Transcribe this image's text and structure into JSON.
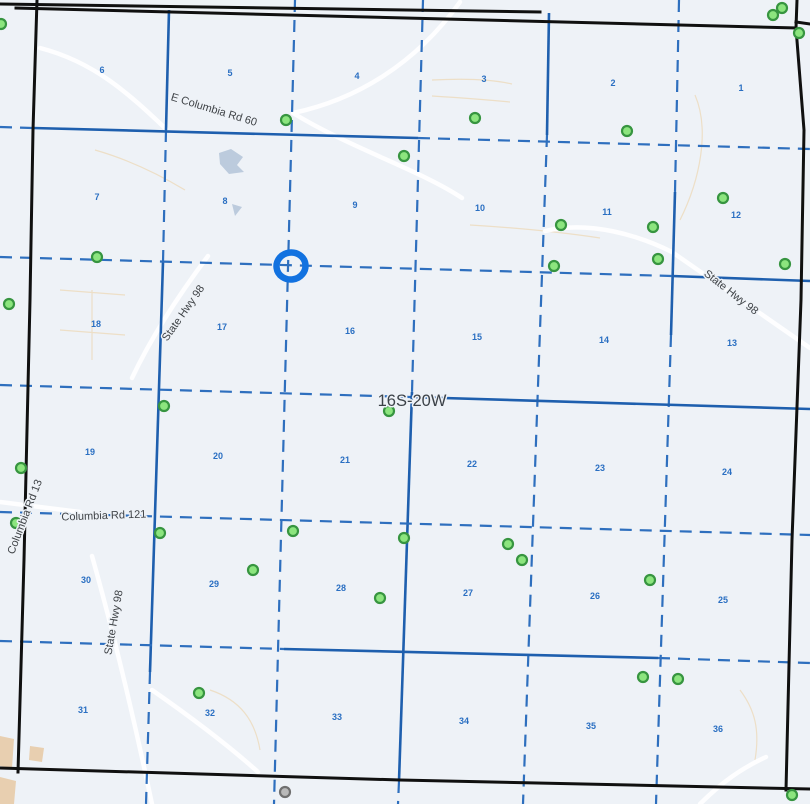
{
  "map": {
    "width": 810,
    "height": 804,
    "background": "#eef2f7"
  },
  "township_label": {
    "text": "16S-20W",
    "x": 412,
    "y": 406
  },
  "road_labels": [
    {
      "label": "E Columbia Rd 60",
      "x": 213,
      "y": 113,
      "rotation": 17
    },
    {
      "label": "State Hwy 98",
      "x": 186,
      "y": 315,
      "rotation": -55
    },
    {
      "label": "State Hwy 98",
      "x": 729,
      "y": 295,
      "rotation": 38
    },
    {
      "label": "Columbia Rd 13",
      "x": 28,
      "y": 518,
      "rotation": -69
    },
    {
      "label": "Columbia Rd 121",
      "x": 104,
      "y": 519,
      "rotation": -2
    },
    {
      "label": "State Hwy 98",
      "x": 117,
      "y": 623,
      "rotation": -80
    }
  ],
  "section_numbers": [
    {
      "n": "6",
      "x": 102,
      "y": 73
    },
    {
      "n": "5",
      "x": 230,
      "y": 76
    },
    {
      "n": "4",
      "x": 357,
      "y": 79
    },
    {
      "n": "3",
      "x": 484,
      "y": 82
    },
    {
      "n": "2",
      "x": 613,
      "y": 86
    },
    {
      "n": "1",
      "x": 741,
      "y": 91
    },
    {
      "n": "7",
      "x": 97,
      "y": 200
    },
    {
      "n": "8",
      "x": 225,
      "y": 204
    },
    {
      "n": "9",
      "x": 355,
      "y": 208
    },
    {
      "n": "10",
      "x": 480,
      "y": 211
    },
    {
      "n": "11",
      "x": 607,
      "y": 215
    },
    {
      "n": "12",
      "x": 736,
      "y": 218
    },
    {
      "n": "18",
      "x": 96,
      "y": 327
    },
    {
      "n": "17",
      "x": 222,
      "y": 330
    },
    {
      "n": "16",
      "x": 350,
      "y": 334
    },
    {
      "n": "15",
      "x": 477,
      "y": 340
    },
    {
      "n": "14",
      "x": 604,
      "y": 343
    },
    {
      "n": "13",
      "x": 732,
      "y": 346
    },
    {
      "n": "19",
      "x": 90,
      "y": 455
    },
    {
      "n": "20",
      "x": 218,
      "y": 459
    },
    {
      "n": "21",
      "x": 345,
      "y": 463
    },
    {
      "n": "22",
      "x": 472,
      "y": 467
    },
    {
      "n": "23",
      "x": 600,
      "y": 471
    },
    {
      "n": "24",
      "x": 727,
      "y": 475
    },
    {
      "n": "30",
      "x": 86,
      "y": 583
    },
    {
      "n": "29",
      "x": 214,
      "y": 587
    },
    {
      "n": "28",
      "x": 341,
      "y": 591
    },
    {
      "n": "27",
      "x": 468,
      "y": 596
    },
    {
      "n": "26",
      "x": 595,
      "y": 599
    },
    {
      "n": "25",
      "x": 723,
      "y": 603
    },
    {
      "n": "31",
      "x": 83,
      "y": 713
    },
    {
      "n": "32",
      "x": 210,
      "y": 716
    },
    {
      "n": "33",
      "x": 337,
      "y": 720
    },
    {
      "n": "34",
      "x": 464,
      "y": 724
    },
    {
      "n": "35",
      "x": 591,
      "y": 729
    },
    {
      "n": "36",
      "x": 718,
      "y": 732
    }
  ],
  "wells": [
    [
      1,
      24
    ],
    [
      773,
      15
    ],
    [
      782,
      8
    ],
    [
      799,
      33
    ],
    [
      286,
      120
    ],
    [
      475,
      118
    ],
    [
      627,
      131
    ],
    [
      404,
      156
    ],
    [
      723,
      198
    ],
    [
      561,
      225
    ],
    [
      653,
      227
    ],
    [
      97,
      257
    ],
    [
      554,
      266
    ],
    [
      658,
      259
    ],
    [
      785,
      264
    ],
    [
      9,
      304
    ],
    [
      164,
      406
    ],
    [
      389,
      411
    ],
    [
      21,
      468
    ],
    [
      16,
      523
    ],
    [
      160,
      533
    ],
    [
      293,
      531
    ],
    [
      404,
      538
    ],
    [
      508,
      544
    ],
    [
      522,
      560
    ],
    [
      253,
      570
    ],
    [
      380,
      598
    ],
    [
      650,
      580
    ],
    [
      199,
      693
    ],
    [
      643,
      677
    ],
    [
      678,
      679
    ],
    [
      792,
      795
    ]
  ],
  "gray_markers": [
    [
      285,
      792
    ]
  ],
  "selection": {
    "x": 291,
    "y": 266,
    "rx": 14.5,
    "ry": 13.5,
    "rotation": -8
  },
  "grid": {
    "boundary": [
      "M 0,4 L 540,12",
      "M 16,8 L 796,28",
      "M 797,0 L 796,28",
      "M 796,22 L 810,24",
      "M 37,0 L 33,130 L 30,300 L 24,560 L 18,772",
      "M 796,28 L 804,130 L 801,300 L 792,540 L 786,790",
      "M 0,768 L 400,780 L 810,789"
    ],
    "blue": [
      [
        169,
        10,
        166,
        130,
        "solid"
      ],
      [
        166,
        130,
        163,
        262,
        "dashed"
      ],
      [
        163,
        262,
        150,
        672,
        "solid"
      ],
      [
        150,
        672,
        146,
        804,
        "dashed"
      ],
      [
        295,
        0,
        274,
        804,
        "dashed"
      ],
      [
        423,
        0,
        412,
        392,
        "dashed"
      ],
      [
        412,
        392,
        399,
        781,
        "solid"
      ],
      [
        399,
        781,
        398,
        804,
        "dashed"
      ],
      [
        549,
        13,
        547,
        135,
        "solid"
      ],
      [
        547,
        135,
        523,
        804,
        "dashed"
      ],
      [
        679,
        0,
        675,
        192,
        "dashed"
      ],
      [
        675,
        192,
        671,
        335,
        "solid"
      ],
      [
        671,
        335,
        656,
        804,
        "dashed"
      ],
      [
        0,
        127,
        33,
        128,
        "dashed"
      ],
      [
        33,
        128,
        418,
        138,
        "solid"
      ],
      [
        418,
        138,
        810,
        149,
        "dashed"
      ],
      [
        0,
        257,
        672,
        276,
        "dashed"
      ],
      [
        672,
        276,
        810,
        281,
        "solid"
      ],
      [
        0,
        385,
        410,
        397,
        "dashed"
      ],
      [
        410,
        397,
        810,
        409,
        "solid"
      ],
      [
        0,
        512,
        810,
        535,
        "dashed"
      ],
      [
        0,
        641,
        284,
        649,
        "dashed"
      ],
      [
        284,
        649,
        658,
        658,
        "solid"
      ],
      [
        658,
        658,
        810,
        663,
        "dashed"
      ]
    ]
  },
  "decor": {
    "white_roads": [
      "M 40,48 C 95,62 130,95 166,129",
      "M 460,2 C 415,65 355,100 293,113",
      "M 293,113 C 350,148 420,170 462,198",
      "M 545,231 C 590,220 640,236 672,252",
      "M 672,252 L 810,348",
      "M 208,256 C 175,300 150,340 132,378",
      "M 0,502 C 30,506 55,509 80,512",
      "M 92,556 C 110,620 130,700 152,804",
      "M 152,690 C 195,720 228,745 258,772",
      "M 700,804 C 722,782 742,768 766,757"
    ],
    "parcel_lines": [
      "M 60,290 L 125,295 M 60,330 L 125,335 M 92,290 L 92,360",
      "M 432,80 C 470,78 495,80 512,84 M 432,96 C 465,98 490,100 510,102",
      "M 695,95 C 710,130 700,180 680,220",
      "M 470,225 C 520,228 560,232 600,238",
      "M 210,690 C 240,700 255,720 260,750",
      "M 740,690 C 755,710 760,730 755,760",
      "M 95,150 C 130,160 160,175 185,190"
    ],
    "ponds": [
      "219,153 231,149 243,157 237,165 244,172 229,174 220,164",
      "232,204 242,207 235,216"
    ],
    "tan_patches": [
      "0,736 14,739 12,768 0,766",
      "0,777 16,781 14,804 0,804",
      "30,746 44,748 42,762 29,760"
    ]
  },
  "colors": {
    "background": "#eef2f7",
    "section_line": "#2e6fbe",
    "road_line": "#1e5fae",
    "boundary": "#101010",
    "section_number": "#2a6fc2",
    "road_label_text": "#3f4347",
    "well_fill": "#8ce57e",
    "well_stroke": "#379540",
    "gray_fill": "#b9b9b9",
    "gray_stroke": "#707070",
    "selection_ring": "#1272e0",
    "water": "#bccbdd",
    "urban_tan": "#e6c9a3"
  }
}
